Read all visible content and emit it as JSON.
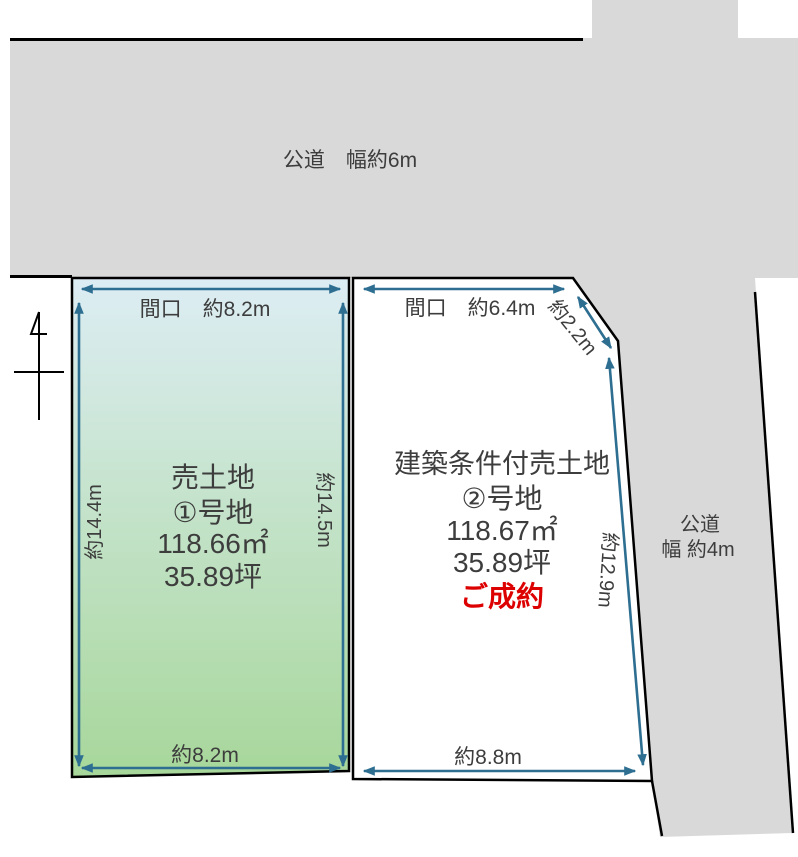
{
  "colors": {
    "road_fill": "#d9d9d9",
    "outline": "#000000",
    "arrow": "#2d6e91",
    "text": "#3d3d3d",
    "sold_red": "#dd0000",
    "lot1_gradient_top": "#ddedf4",
    "lot1_gradient_bottom": "#a7d79a",
    "lot2_fill": "#ffffff"
  },
  "roads": {
    "top": {
      "label": "公道　幅約6m"
    },
    "right": {
      "label_line1": "公道",
      "label_line2": "幅 約4m"
    }
  },
  "lots": {
    "lot1": {
      "title": "売土地",
      "number": "①号地",
      "area_m2": "118.66㎡",
      "area_tsubo": "35.89坪",
      "frontage_label": "間口　約8.2m",
      "side_left": "約14.4m",
      "side_right": "約14.5m",
      "bottom": "約8.2m"
    },
    "lot2": {
      "title": "建築条件付売土地",
      "number": "②号地",
      "area_m2": "118.67㎡",
      "area_tsubo": "35.89坪",
      "status": "ご成約",
      "frontage_label": "間口　約6.4m",
      "corner": "約2.2m",
      "side_right": "約12.9m",
      "bottom": "約8.8m"
    }
  }
}
